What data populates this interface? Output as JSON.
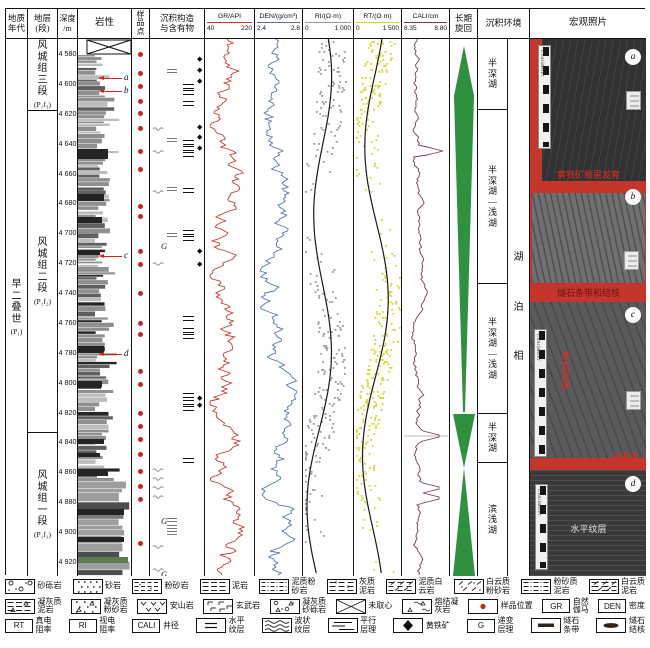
{
  "header": {
    "age": [
      "地质",
      "年代"
    ],
    "formation": [
      "地层",
      "(段)"
    ],
    "depth": [
      "深度",
      "/m"
    ],
    "lithology": "岩性",
    "sample": "样品点",
    "structures": [
      "沉积构造",
      "与含有物"
    ],
    "cycle": [
      "长期",
      "旋回"
    ],
    "environment": "沉积环境",
    "photos": "宏观照片"
  },
  "tracks": [
    {
      "id": "GR",
      "title": "GR/API",
      "min": "40",
      "max": "220",
      "color": "#c23b2e"
    },
    {
      "id": "DEN",
      "title": "DEN/(g/cm³)",
      "min": "2.4",
      "max": "2.8",
      "color": "#5274ae"
    },
    {
      "id": "RI",
      "title": "RI/(Ω·m)",
      "min": "0",
      "max": "1 000",
      "color": "#9a9a9a"
    },
    {
      "id": "RT",
      "title": "RT/(Ω·m)",
      "min": "0",
      "max": "1 500",
      "color": "#d6d62c"
    },
    {
      "id": "CALI",
      "title": "CALI/cm",
      "min": "8.35",
      "max": "8.80",
      "color": "#7e3a49"
    }
  ],
  "age": {
    "chars": "早二叠世",
    "code": "(P₁)"
  },
  "formations": [
    {
      "chars": "风城组三段",
      "code": "(P₁f₃)",
      "top": 38,
      "bottom": 110
    },
    {
      "chars": "风城组二段",
      "code": "(P₁f₂)",
      "top": 110,
      "bottom": 432
    },
    {
      "chars": "风城组一段",
      "code": "(P₁f₁)",
      "top": 432,
      "bottom": 575
    }
  ],
  "depth_scale": {
    "top_depth": 4580,
    "top_y": 52,
    "px_per_m": 1.494,
    "tick_step": 20,
    "tick_count": 18
  },
  "depth_tick_labels": [
    "4 580",
    "4 600",
    "4 620",
    "4 640",
    "4 660",
    "4 680",
    "4 700",
    "4 720",
    "4 740",
    "4 760",
    "4 780",
    "4 800",
    "4 820",
    "4 840",
    "4 860",
    "4 880",
    "4 900",
    "4 920"
  ],
  "arrows": [
    {
      "label": "a",
      "y": 77
    },
    {
      "label": "b",
      "y": 90
    },
    {
      "label": "c",
      "y": 255
    },
    {
      "label": "d",
      "y": 353
    }
  ],
  "sample_dots_y": [
    53,
    72,
    85,
    100,
    112,
    127,
    150,
    168,
    205,
    215,
    250,
    263,
    292,
    322,
    333,
    370,
    383,
    412,
    425,
    438,
    453,
    470,
    485,
    498,
    542
  ],
  "struct_symbols": [
    {
      "t": "diamond",
      "y": 58
    },
    {
      "t": "diamond",
      "y": 69
    },
    {
      "t": "diamond",
      "y": 80
    },
    {
      "t": "chert",
      "y": 71
    },
    {
      "t": "bars",
      "y": 86
    },
    {
      "t": "bars",
      "y": 92
    },
    {
      "t": "bars",
      "y": 103
    },
    {
      "t": "diamond",
      "y": 126
    },
    {
      "t": "diamond",
      "y": 136
    },
    {
      "t": "diamond",
      "y": 147
    },
    {
      "t": "wavy",
      "y": 127
    },
    {
      "t": "chert",
      "y": 140
    },
    {
      "t": "bars",
      "y": 142
    },
    {
      "t": "bars",
      "y": 148
    },
    {
      "t": "bars",
      "y": 154
    },
    {
      "t": "wavy",
      "y": 150
    },
    {
      "t": "chert",
      "y": 189
    },
    {
      "t": "bars",
      "y": 190
    },
    {
      "t": "wavy",
      "y": 190
    },
    {
      "t": "chert",
      "y": 235
    },
    {
      "t": "bars",
      "y": 232
    },
    {
      "t": "bars",
      "y": 238
    },
    {
      "t": "g",
      "y": 245
    },
    {
      "t": "diamond",
      "y": 250
    },
    {
      "t": "diamond",
      "y": 263
    },
    {
      "t": "wavy",
      "y": 262
    },
    {
      "t": "bars",
      "y": 318
    },
    {
      "t": "bars",
      "y": 330
    },
    {
      "t": "bars",
      "y": 336
    },
    {
      "t": "bars",
      "y": 395
    },
    {
      "t": "bars",
      "y": 402
    },
    {
      "t": "bars",
      "y": 408
    },
    {
      "t": "diamond",
      "y": 397
    },
    {
      "t": "diamond",
      "y": 404
    },
    {
      "t": "bars",
      "y": 460
    },
    {
      "t": "wavy",
      "y": 468
    },
    {
      "t": "wavy",
      "y": 477
    },
    {
      "t": "wavy",
      "y": 486
    },
    {
      "t": "wavy",
      "y": 495
    },
    {
      "t": "chert",
      "y": 520
    },
    {
      "t": "chert",
      "y": 527
    },
    {
      "t": "chert",
      "y": 533
    },
    {
      "t": "g",
      "y": 520
    },
    {
      "t": "wavy",
      "y": 545
    },
    {
      "t": "wavy",
      "y": 568
    },
    {
      "t": "g",
      "y": 573
    }
  ],
  "cycle": {
    "color": "#2f9140",
    "shapes": [
      [
        [
          14,
          7
        ],
        [
          24,
          57
        ],
        [
          15,
          373
        ],
        [
          13,
          373
        ],
        [
          4,
          57
        ]
      ],
      [
        [
          3,
          375
        ],
        [
          25,
          375
        ],
        [
          14,
          429
        ]
      ],
      [
        [
          14,
          429
        ],
        [
          25,
          537
        ],
        [
          3,
          537
        ]
      ]
    ]
  },
  "environment": {
    "sections": [
      {
        "label": "半深湖",
        "top": 38,
        "bottom": 109
      },
      {
        "label": "半深湖—浅湖",
        "top": 109,
        "bottom": 283
      },
      {
        "label": "半深湖—浅湖",
        "top": 283,
        "bottom": 413
      },
      {
        "label": "半深湖",
        "top": 413,
        "bottom": 462
      },
      {
        "label": "滨浅湖",
        "top": 462,
        "bottom": 575
      }
    ],
    "facies": "湖泊相"
  },
  "photos": [
    {
      "label": "a",
      "top": 38,
      "bottom": 180,
      "rock": 0,
      "ruler": true,
      "ruler_text": "Centimeter",
      "card": true,
      "annotations": [
        {
          "text": "黄铁矿顺层发育",
          "pos": "bottom",
          "color": "red"
        }
      ]
    },
    {
      "label": "b",
      "top": 180,
      "bottom": 298,
      "rock": 1,
      "ruler": false,
      "ruler_text": "",
      "card": true,
      "annotations": [
        {
          "text": "燧石条带和结核",
          "pos": "bottom",
          "color": "darkred"
        }
      ]
    },
    {
      "label": "c",
      "top": 298,
      "bottom": 467,
      "rock": 2,
      "ruler": true,
      "ruler_text": "Centimeter",
      "card": true,
      "annotations": [
        {
          "text": "递变层理",
          "pos": "vert",
          "color": "red"
        },
        {
          "text": "冲刷面",
          "pos": "br",
          "color": "red"
        }
      ]
    },
    {
      "label": "d",
      "top": 467,
      "bottom": 575,
      "rock": 3,
      "ruler": true,
      "ruler_text": "Centimeter",
      "card": false,
      "annotations": [
        {
          "text": "水平纹层",
          "pos": "center",
          "color": "white"
        }
      ]
    }
  ],
  "lithology": {
    "seed": 7,
    "no_core_box": true,
    "wide_from_y": 478,
    "dark_bands": [
      {
        "y": 148,
        "h": 10,
        "w": 30
      },
      {
        "y": 193,
        "h": 7,
        "w": 26
      },
      {
        "y": 216,
        "h": 6,
        "w": 24
      },
      {
        "y": 250,
        "h": 4,
        "w": 22
      },
      {
        "y": 345,
        "h": 7,
        "w": 26
      },
      {
        "y": 380,
        "h": 6,
        "w": 24
      },
      {
        "y": 438,
        "h": 5,
        "w": 26
      },
      {
        "y": 452,
        "h": 4,
        "w": 22
      },
      {
        "y": 470,
        "h": 5,
        "w": 30
      },
      {
        "y": 508,
        "h": 6,
        "w": 46
      },
      {
        "y": 536,
        "h": 5,
        "w": 46
      }
    ],
    "green_band": {
      "y": 556,
      "h": 6,
      "w": 50,
      "color": "#5d7a52"
    }
  },
  "curve_seed": 11,
  "cali_spikes_y": [
    150,
    435,
    487,
    497
  ],
  "sample_dot_color": "#c3271b",
  "legend": {
    "rows": [
      [
        {
          "sym": "gravel",
          "label": [
            "砂砾岩"
          ]
        },
        {
          "sym": "sand",
          "label": [
            "砂岩"
          ]
        },
        {
          "sym": "silt",
          "label": [
            "粉砂岩"
          ]
        },
        {
          "sym": "mud",
          "label": [
            "泥岩"
          ]
        },
        {
          "sym": "muddysilt",
          "label": [
            "泥质粉",
            "砂岩"
          ]
        },
        {
          "sym": "limymud",
          "label": [
            "灰质",
            "泥岩"
          ]
        },
        {
          "sym": "muddydolo",
          "label": [
            "泥质白",
            "云岩"
          ]
        },
        {
          "sym": "dolosilt",
          "label": [
            "白云质",
            "粉砂岩"
          ]
        },
        {
          "sym": "siltymud",
          "label": [
            "粉砂质",
            "泥岩"
          ]
        },
        {
          "sym": "dolomud",
          "label": [
            "白云质",
            "泥岩"
          ]
        }
      ],
      [
        {
          "sym": "tuffmud",
          "label": [
            "凝灰质",
            "泥岩"
          ]
        },
        {
          "sym": "tuffsilt",
          "label": [
            "凝灰质",
            "粉砂岩"
          ]
        },
        {
          "sym": "andesite",
          "label": [
            "安山岩"
          ]
        },
        {
          "sym": "basalt",
          "label": [
            "玄武岩"
          ]
        },
        {
          "sym": "tuffgravel",
          "label": [
            "凝灰质",
            "砂砾岩"
          ]
        },
        {
          "sym": "nocore",
          "label": [
            "未取心"
          ]
        },
        {
          "sym": "weldedtuff",
          "label": [
            "熔结凝",
            "灰岩"
          ]
        },
        {
          "sym": "sampledot",
          "label": [
            "样品位置"
          ]
        },
        {
          "sym": "lbox",
          "letter": "GR",
          "label": [
            "自然",
            "伽马"
          ]
        },
        {
          "sym": "lbox",
          "letter": "DEN",
          "label": [
            "密度"
          ]
        }
      ],
      [
        {
          "sym": "lbox",
          "letter": "RT",
          "label": [
            "真电",
            "阻率"
          ]
        },
        {
          "sym": "lbox",
          "letter": "RI",
          "label": [
            "视电",
            "阻率"
          ]
        },
        {
          "sym": "lbox",
          "letter": "CALI",
          "label": [
            "井径"
          ]
        },
        {
          "sym": "hlam",
          "label": [
            "水平",
            "纹层"
          ]
        },
        {
          "sym": "wavylam",
          "label": [
            "波状",
            "纹层"
          ]
        },
        {
          "sym": "plam",
          "label": [
            "平行",
            "层理"
          ]
        },
        {
          "sym": "pyrite",
          "label": [
            "黄铁矿"
          ]
        },
        {
          "sym": "lbox",
          "letter": "G",
          "label": [
            "递变",
            "层理"
          ]
        },
        {
          "sym": "chertband",
          "label": [
            "燧石",
            "条带"
          ]
        },
        {
          "sym": "chertnodule",
          "label": [
            "燧石",
            "结核"
          ]
        }
      ]
    ]
  }
}
